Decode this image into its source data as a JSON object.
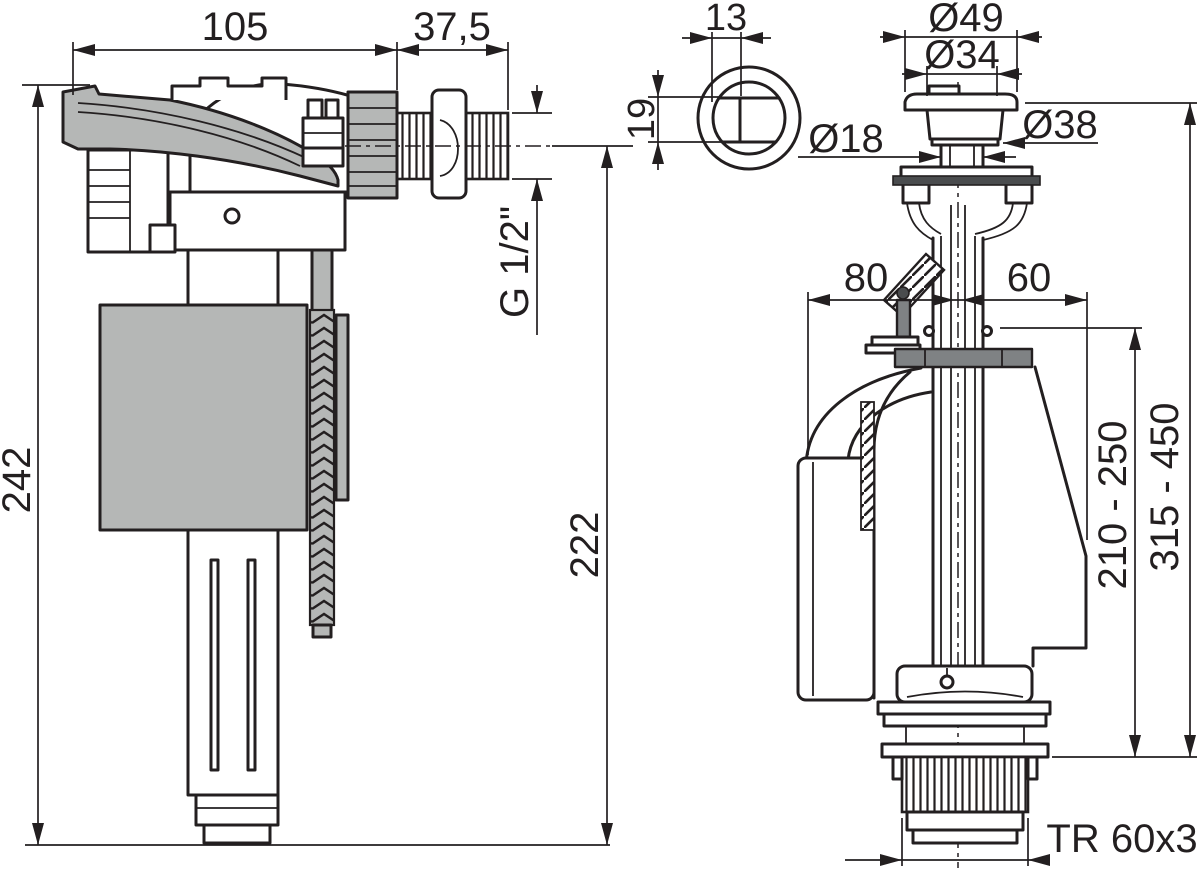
{
  "drawing": {
    "kind": "sanitary-valve-dimension-drawing",
    "colors": {
      "line": "#231f20",
      "light_gray": "#b5b7b6",
      "mid_gray": "#7f8284",
      "dark_gray": "#4a4c4e",
      "background": "#ffffff"
    },
    "fill_valve": {
      "overall_width": "105",
      "thread_length": "37,5",
      "thread_size": "G 1/2\"",
      "overall_height": "242",
      "height_below_axis": "222"
    },
    "push_button": {
      "width": "13",
      "height": "19"
    },
    "flush_valve": {
      "cap_diameter": "Ø49",
      "button_diameter": "Ø34",
      "collar_diameter": "Ø38",
      "stem_diameter": "Ø18",
      "left_offset": "80",
      "right_offset": "60",
      "height_range_inner": "210 - 250",
      "height_range_total": "315 - 450",
      "base_thread": "TR 60x3"
    }
  }
}
